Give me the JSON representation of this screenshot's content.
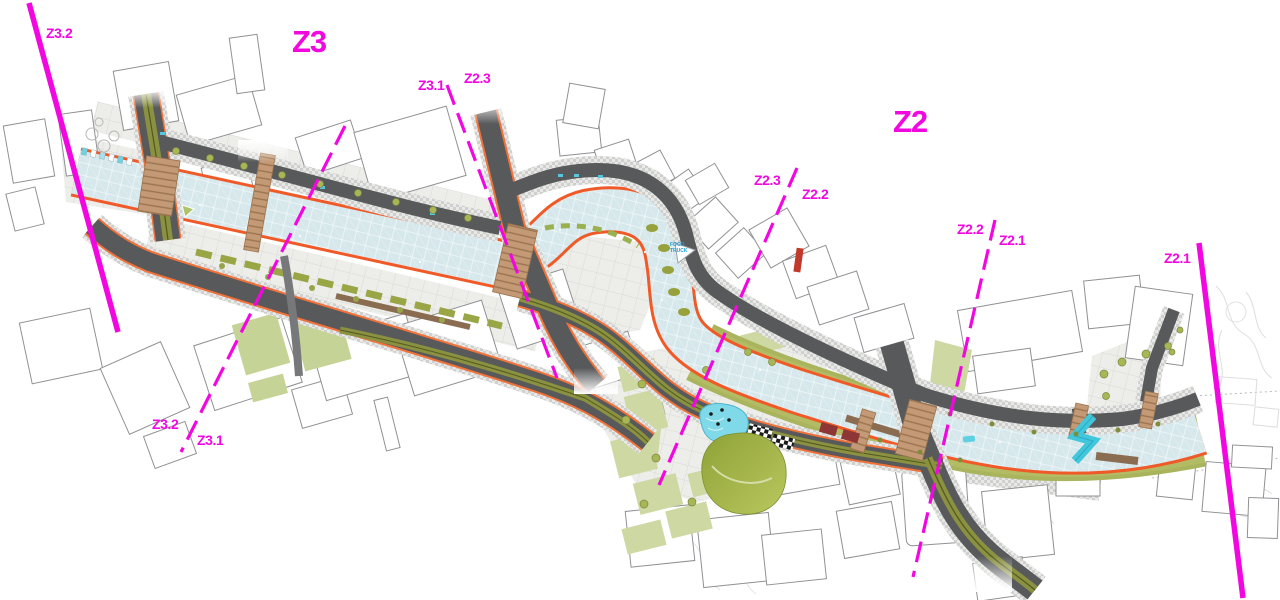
{
  "colors": {
    "magenta": "#f307e0",
    "canal_water": "#d6e8ec",
    "road": "#58595b",
    "promenade_orange": "#f05a28",
    "park_light": "#cdd8a2",
    "hill_green": "#8ea238",
    "pond_cyan": "#7fd9e9",
    "bank_olive": "#a9b45c",
    "bridge_deck_tan": "#c49a76",
    "boardwalk_brown": "#8a6d50",
    "building_stroke": "#909194",
    "food_truck_blue": "#1b9cd8"
  },
  "labels": {
    "z32_top": "Z3.2",
    "z3": "Z3",
    "z31_top": "Z3.1",
    "z23_top": "Z2.3",
    "z2": "Z2",
    "z23_mid": "Z2.3",
    "z22_mid": "Z2.2",
    "z22_right": "Z2.2",
    "z21_right": "Z2.1",
    "z21_far": "Z2.1",
    "z32_bottom": "Z3.2",
    "z31_bottom": "Z3.1",
    "food_truck_line1": "FOOD",
    "food_truck_line2": "TRUCK"
  }
}
